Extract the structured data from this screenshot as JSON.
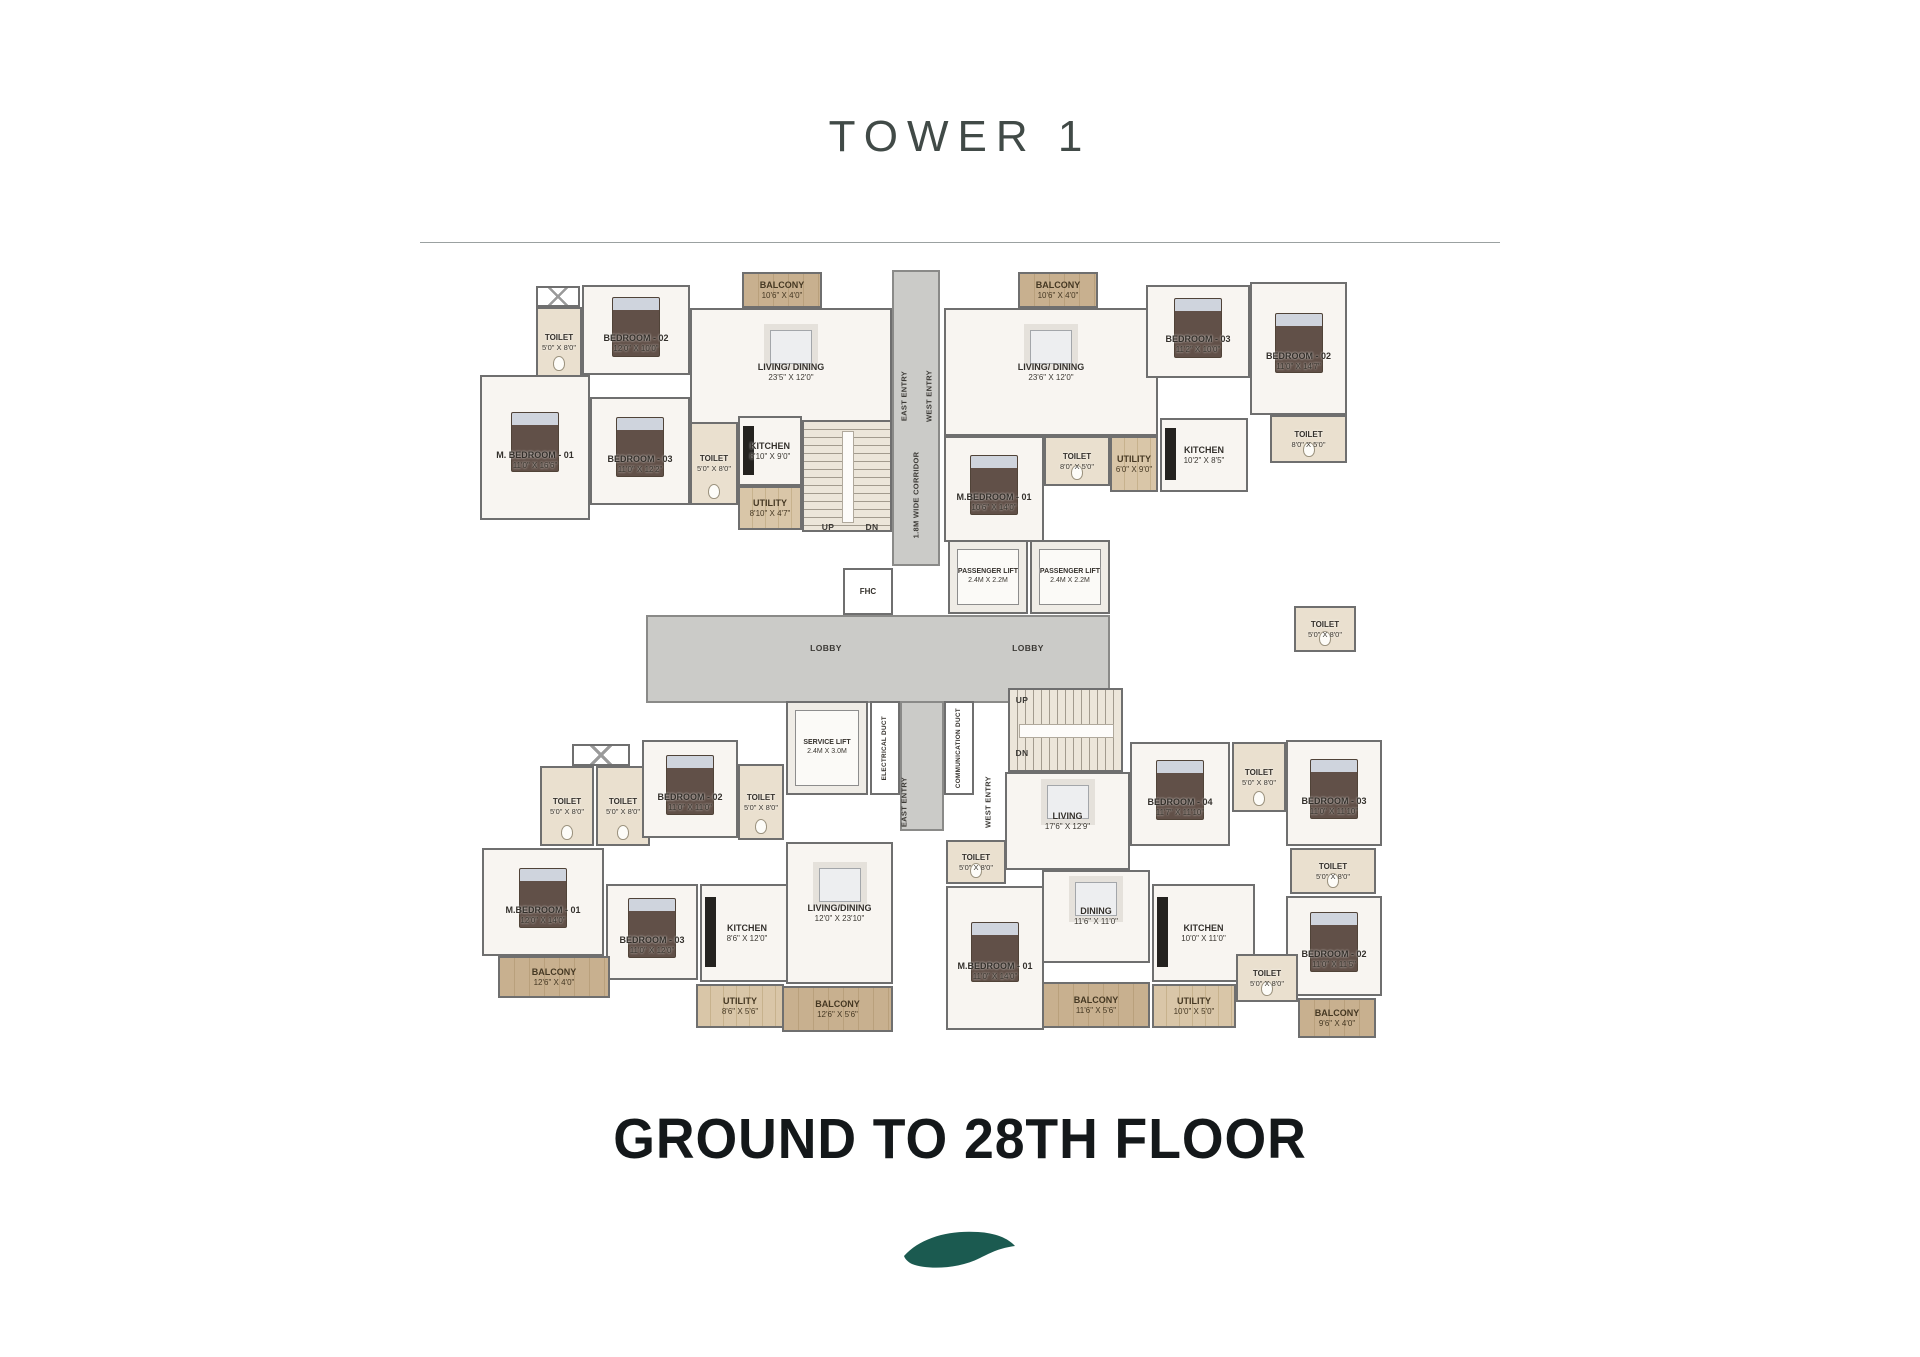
{
  "header": {
    "title": "TOWER 1"
  },
  "footer": {
    "heading": "GROUND TO 28TH FLOOR"
  },
  "colors": {
    "wall": "#6F6F6F",
    "floor": "#F8F5F1",
    "toilet_floor": "#EAE0CF",
    "wood": "#C8B08F",
    "wood_light": "#D9C6A8",
    "lobby": "#CBCBC8",
    "leaf": "#1B5A50",
    "title": "#414A47",
    "heading": "#14181A"
  },
  "plan": {
    "rooms": [
      {
        "id": "corridor-main",
        "type": "corridor",
        "x": 892,
        "y": 270,
        "w": 48,
        "h": 296
      },
      {
        "id": "lobby",
        "type": "lobby",
        "x": 646,
        "y": 615,
        "w": 464,
        "h": 88
      },
      {
        "id": "corridor-bottom",
        "type": "corridor",
        "x": 900,
        "y": 701,
        "w": 44,
        "h": 130
      },
      {
        "id": "tl-shaft",
        "type": "shaft",
        "x": 536,
        "y": 286,
        "w": 44,
        "h": 21
      },
      {
        "id": "tl-toilet-1",
        "type": "toilet",
        "label": "TOILET",
        "dims": "5'0\" X 8'0\"",
        "x": 536,
        "y": 307,
        "w": 46,
        "h": 70
      },
      {
        "id": "tl-bedroom-2",
        "type": "bedroom",
        "label": "BEDROOM - 02",
        "dims": "12'0\" X 10'0\"",
        "x": 582,
        "y": 285,
        "w": 108,
        "h": 90
      },
      {
        "id": "tl-balcony",
        "type": "balcony",
        "label": "BALCONY",
        "dims": "10'6\" X 4'0\"",
        "x": 742,
        "y": 272,
        "w": 80,
        "h": 36
      },
      {
        "id": "tl-living-dining",
        "type": "living",
        "label": "LIVING/ DINING",
        "dims": "23'5\" X 12'0\"",
        "x": 690,
        "y": 308,
        "w": 202,
        "h": 128
      },
      {
        "id": "tl-m-bedroom-1",
        "type": "bedroom",
        "label": "M. BEDROOM - 01",
        "dims": "11'0\" X 16'6\"",
        "x": 480,
        "y": 375,
        "w": 110,
        "h": 145
      },
      {
        "id": "tl-bedroom-3",
        "type": "bedroom",
        "label": "BEDROOM - 03",
        "dims": "11'0\" X 12'2\"",
        "x": 590,
        "y": 397,
        "w": 100,
        "h": 108
      },
      {
        "id": "tl-toilet-2",
        "type": "toilet",
        "label": "TOILET",
        "dims": "5'0\" X 8'0\"",
        "x": 690,
        "y": 422,
        "w": 48,
        "h": 83
      },
      {
        "id": "tl-kitchen",
        "type": "kitchen",
        "label": "KITCHEN",
        "dims": "8'10\" X 9'0\"",
        "x": 738,
        "y": 416,
        "w": 64,
        "h": 70
      },
      {
        "id": "tl-utility",
        "type": "utility",
        "label": "UTILITY",
        "dims": "8'10\" X 4'7\"",
        "x": 738,
        "y": 486,
        "w": 64,
        "h": 44
      },
      {
        "id": "stairs-1",
        "type": "stairs",
        "x": 802,
        "y": 420,
        "w": 90,
        "h": 112
      },
      {
        "id": "fhc",
        "type": "fhc",
        "label": "FHC",
        "x": 843,
        "y": 568,
        "w": 50,
        "h": 47
      },
      {
        "id": "passenger-lift-1",
        "type": "lift",
        "label": "PASSENGER LIFT",
        "dims": "2.4M X 2.2M",
        "x": 948,
        "y": 540,
        "w": 80,
        "h": 74
      },
      {
        "id": "passenger-lift-2",
        "type": "lift",
        "label": "PASSENGER LIFT",
        "dims": "2.4M X 2.2M",
        "x": 1030,
        "y": 540,
        "w": 80,
        "h": 74
      },
      {
        "id": "service-lift",
        "type": "lift",
        "label": "SERVICE LIFT",
        "dims": "2.4M X 3.0M",
        "x": 786,
        "y": 701,
        "w": 82,
        "h": 94
      },
      {
        "id": "electrical-duct",
        "type": "duct",
        "label": "ELECTRICAL DUCT",
        "x": 870,
        "y": 701,
        "w": 30,
        "h": 94
      },
      {
        "id": "communication-duct",
        "type": "duct",
        "label": "COMMUNICATION DUCT",
        "x": 944,
        "y": 701,
        "w": 30,
        "h": 94
      },
      {
        "id": "stairs-2",
        "type": "stairs",
        "x": 1008,
        "y": 688,
        "w": 115,
        "h": 84
      },
      {
        "id": "tr-balcony",
        "type": "balcony",
        "label": "BALCONY",
        "dims": "10'6\" X 4'0\"",
        "x": 1018,
        "y": 272,
        "w": 80,
        "h": 36
      },
      {
        "id": "tr-living-dining",
        "type": "living",
        "label": "LIVING/ DINING",
        "dims": "23'6\" X 12'0\"",
        "x": 944,
        "y": 308,
        "w": 214,
        "h": 128
      },
      {
        "id": "tr-bedroom-3",
        "type": "bedroom",
        "label": "BEDROOM - 03",
        "dims": "11'2\" X 10'0\"",
        "x": 1146,
        "y": 285,
        "w": 104,
        "h": 93
      },
      {
        "id": "tr-bedroom-2",
        "type": "bedroom",
        "label": "BEDROOM - 02",
        "dims": "11'0\" X 14'7\"",
        "x": 1250,
        "y": 282,
        "w": 97,
        "h": 133
      },
      {
        "id": "tr-toilet-1",
        "type": "toilet",
        "label": "TOILET",
        "dims": "8'0\" X 5'0\"",
        "x": 1270,
        "y": 415,
        "w": 77,
        "h": 48
      },
      {
        "id": "tr-m-bedroom-1",
        "type": "bedroom",
        "label": "M.BEDROOM - 01",
        "dims": "10'6\" X 14'0\"",
        "x": 944,
        "y": 436,
        "w": 100,
        "h": 106
      },
      {
        "id": "tr-toilet-2",
        "type": "toilet",
        "label": "TOILET",
        "dims": "8'0\" X 5'0\"",
        "x": 1044,
        "y": 436,
        "w": 66,
        "h": 50
      },
      {
        "id": "tr-utility",
        "type": "utility",
        "label": "UTILITY",
        "dims": "6'0\" X 9'0\"",
        "x": 1110,
        "y": 436,
        "w": 48,
        "h": 56
      },
      {
        "id": "tr-kitchen",
        "type": "kitchen",
        "label": "KITCHEN",
        "dims": "10'2\" X 8'5\"",
        "x": 1160,
        "y": 418,
        "w": 88,
        "h": 74
      },
      {
        "id": "bl-shaft",
        "type": "shaft",
        "x": 572,
        "y": 744,
        "w": 58,
        "h": 22
      },
      {
        "id": "bl-toilet-1",
        "type": "toilet",
        "label": "TOILET",
        "dims": "5'0\" X 8'0\"",
        "x": 540,
        "y": 766,
        "w": 54,
        "h": 80
      },
      {
        "id": "bl-toilet-2",
        "type": "toilet",
        "label": "TOILET",
        "dims": "5'0\" X 8'0\"",
        "x": 596,
        "y": 766,
        "w": 54,
        "h": 80
      },
      {
        "id": "bl-bedroom-2",
        "type": "bedroom",
        "label": "BEDROOM - 02",
        "dims": "11'0\" X 11'0\"",
        "x": 642,
        "y": 740,
        "w": 96,
        "h": 98
      },
      {
        "id": "bl-toilet-3",
        "type": "toilet",
        "label": "TOILET",
        "dims": "5'0\" X 8'0\"",
        "x": 738,
        "y": 764,
        "w": 46,
        "h": 76
      },
      {
        "id": "bl-m-bedroom-1",
        "type": "bedroom",
        "label": "M.BEDROOM - 01",
        "dims": "12'0\" X 14'0\"",
        "x": 482,
        "y": 848,
        "w": 122,
        "h": 108
      },
      {
        "id": "bl-bedroom-3",
        "type": "bedroom",
        "label": "BEDROOM - 03",
        "dims": "11'0\" X 12'0\"",
        "x": 606,
        "y": 884,
        "w": 92,
        "h": 96
      },
      {
        "id": "bl-kitchen",
        "type": "kitchen",
        "label": "KITCHEN",
        "dims": "8'6\" X 12'0\"",
        "x": 700,
        "y": 884,
        "w": 94,
        "h": 98
      },
      {
        "id": "bl-balcony-1",
        "type": "balcony",
        "label": "BALCONY",
        "dims": "12'6\" X 4'0\"",
        "x": 498,
        "y": 956,
        "w": 112,
        "h": 42
      },
      {
        "id": "bl-utility",
        "type": "utility",
        "label": "UTILITY",
        "dims": "8'6\" X 5'6\"",
        "x": 696,
        "y": 984,
        "w": 88,
        "h": 44
      },
      {
        "id": "bl-living-dining",
        "type": "living",
        "label": "LIVING/DINING",
        "dims": "12'0\" X 23'10\"",
        "x": 786,
        "y": 842,
        "w": 107,
        "h": 142
      },
      {
        "id": "bl-balcony-2",
        "type": "balcony",
        "label": "BALCONY",
        "dims": "12'6\" X 5'6\"",
        "x": 782,
        "y": 986,
        "w": 111,
        "h": 46
      },
      {
        "id": "br-toilet-top",
        "type": "toilet",
        "label": "TOILET",
        "dims": "5'0\" X 8'0\"",
        "x": 1294,
        "y": 606,
        "w": 62,
        "h": 46
      },
      {
        "id": "br-living",
        "type": "living",
        "label": "LIVING",
        "dims": "17'6\" X 12'9\"",
        "x": 1005,
        "y": 772,
        "w": 125,
        "h": 98
      },
      {
        "id": "br-bedroom-4",
        "type": "bedroom",
        "label": "BEDROOM - 04",
        "dims": "11'7\" X 11'10\"",
        "x": 1130,
        "y": 742,
        "w": 100,
        "h": 104
      },
      {
        "id": "br-toilet-a",
        "type": "toilet",
        "label": "TOILET",
        "dims": "5'0\" X 8'0\"",
        "x": 1232,
        "y": 742,
        "w": 54,
        "h": 70
      },
      {
        "id": "br-bedroom-3",
        "type": "bedroom",
        "label": "BEDROOM - 03",
        "dims": "11'0\" X 11'10\"",
        "x": 1286,
        "y": 740,
        "w": 96,
        "h": 106
      },
      {
        "id": "br-toilet-b",
        "type": "toilet",
        "label": "TOILET",
        "dims": "5'0\" X 8'0\"",
        "x": 1290,
        "y": 848,
        "w": 86,
        "h": 46
      },
      {
        "id": "br-bedroom-2",
        "type": "bedroom",
        "label": "BEDROOM - 02",
        "dims": "11'0\" X 11'5\"",
        "x": 1286,
        "y": 896,
        "w": 96,
        "h": 100
      },
      {
        "id": "br-balcony-2",
        "type": "balcony",
        "label": "BALCONY",
        "dims": "9'6\" X 4'0\"",
        "x": 1298,
        "y": 998,
        "w": 78,
        "h": 40
      },
      {
        "id": "br-dining",
        "type": "living",
        "label": "DINING",
        "dims": "11'6\" X 11'0\"",
        "x": 1042,
        "y": 870,
        "w": 108,
        "h": 93
      },
      {
        "id": "br-kitchen",
        "type": "kitchen",
        "label": "KITCHEN",
        "dims": "10'0\" X 11'0\"",
        "x": 1152,
        "y": 884,
        "w": 103,
        "h": 98
      },
      {
        "id": "br-toilet-c",
        "type": "toilet",
        "label": "TOILET",
        "dims": "5'0\" X 8'0\"",
        "x": 1236,
        "y": 954,
        "w": 62,
        "h": 48
      },
      {
        "id": "br-balcony-1",
        "type": "balcony",
        "label": "BALCONY",
        "dims": "11'6\" X 5'6\"",
        "x": 1042,
        "y": 982,
        "w": 108,
        "h": 46
      },
      {
        "id": "br-utility",
        "type": "utility",
        "label": "UTILITY",
        "dims": "10'0\" X 5'0\"",
        "x": 1152,
        "y": 984,
        "w": 84,
        "h": 44
      },
      {
        "id": "br-toilet-d",
        "type": "toilet",
        "label": "TOILET",
        "dims": "5'0\" X 8'0\"",
        "x": 946,
        "y": 840,
        "w": 60,
        "h": 44
      },
      {
        "id": "br-m-bedroom-1",
        "type": "bedroom",
        "label": "M.BEDROOM - 01",
        "dims": "11'0\" X 14'0\"",
        "x": 946,
        "y": 886,
        "w": 98,
        "h": 144
      }
    ],
    "vertical_labels": [
      {
        "text": "1.8M WIDE CORRIDOR",
        "x": 916,
        "y": 495
      },
      {
        "text": "EAST ENTRY",
        "x": 904,
        "y": 396
      },
      {
        "text": "WEST ENTRY",
        "x": 929,
        "y": 396
      },
      {
        "text": "EAST ENTRY",
        "x": 904,
        "y": 802
      },
      {
        "text": "WEST ENTRY",
        "x": 988,
        "y": 802
      }
    ],
    "float_labels": [
      {
        "text": "LOBBY",
        "x": 826,
        "y": 648
      },
      {
        "text": "LOBBY",
        "x": 1028,
        "y": 648
      },
      {
        "text": "UP",
        "x": 828,
        "y": 527
      },
      {
        "text": "DN",
        "x": 872,
        "y": 527
      },
      {
        "text": "UP",
        "x": 1022,
        "y": 700
      },
      {
        "text": "DN",
        "x": 1022,
        "y": 753
      }
    ]
  }
}
